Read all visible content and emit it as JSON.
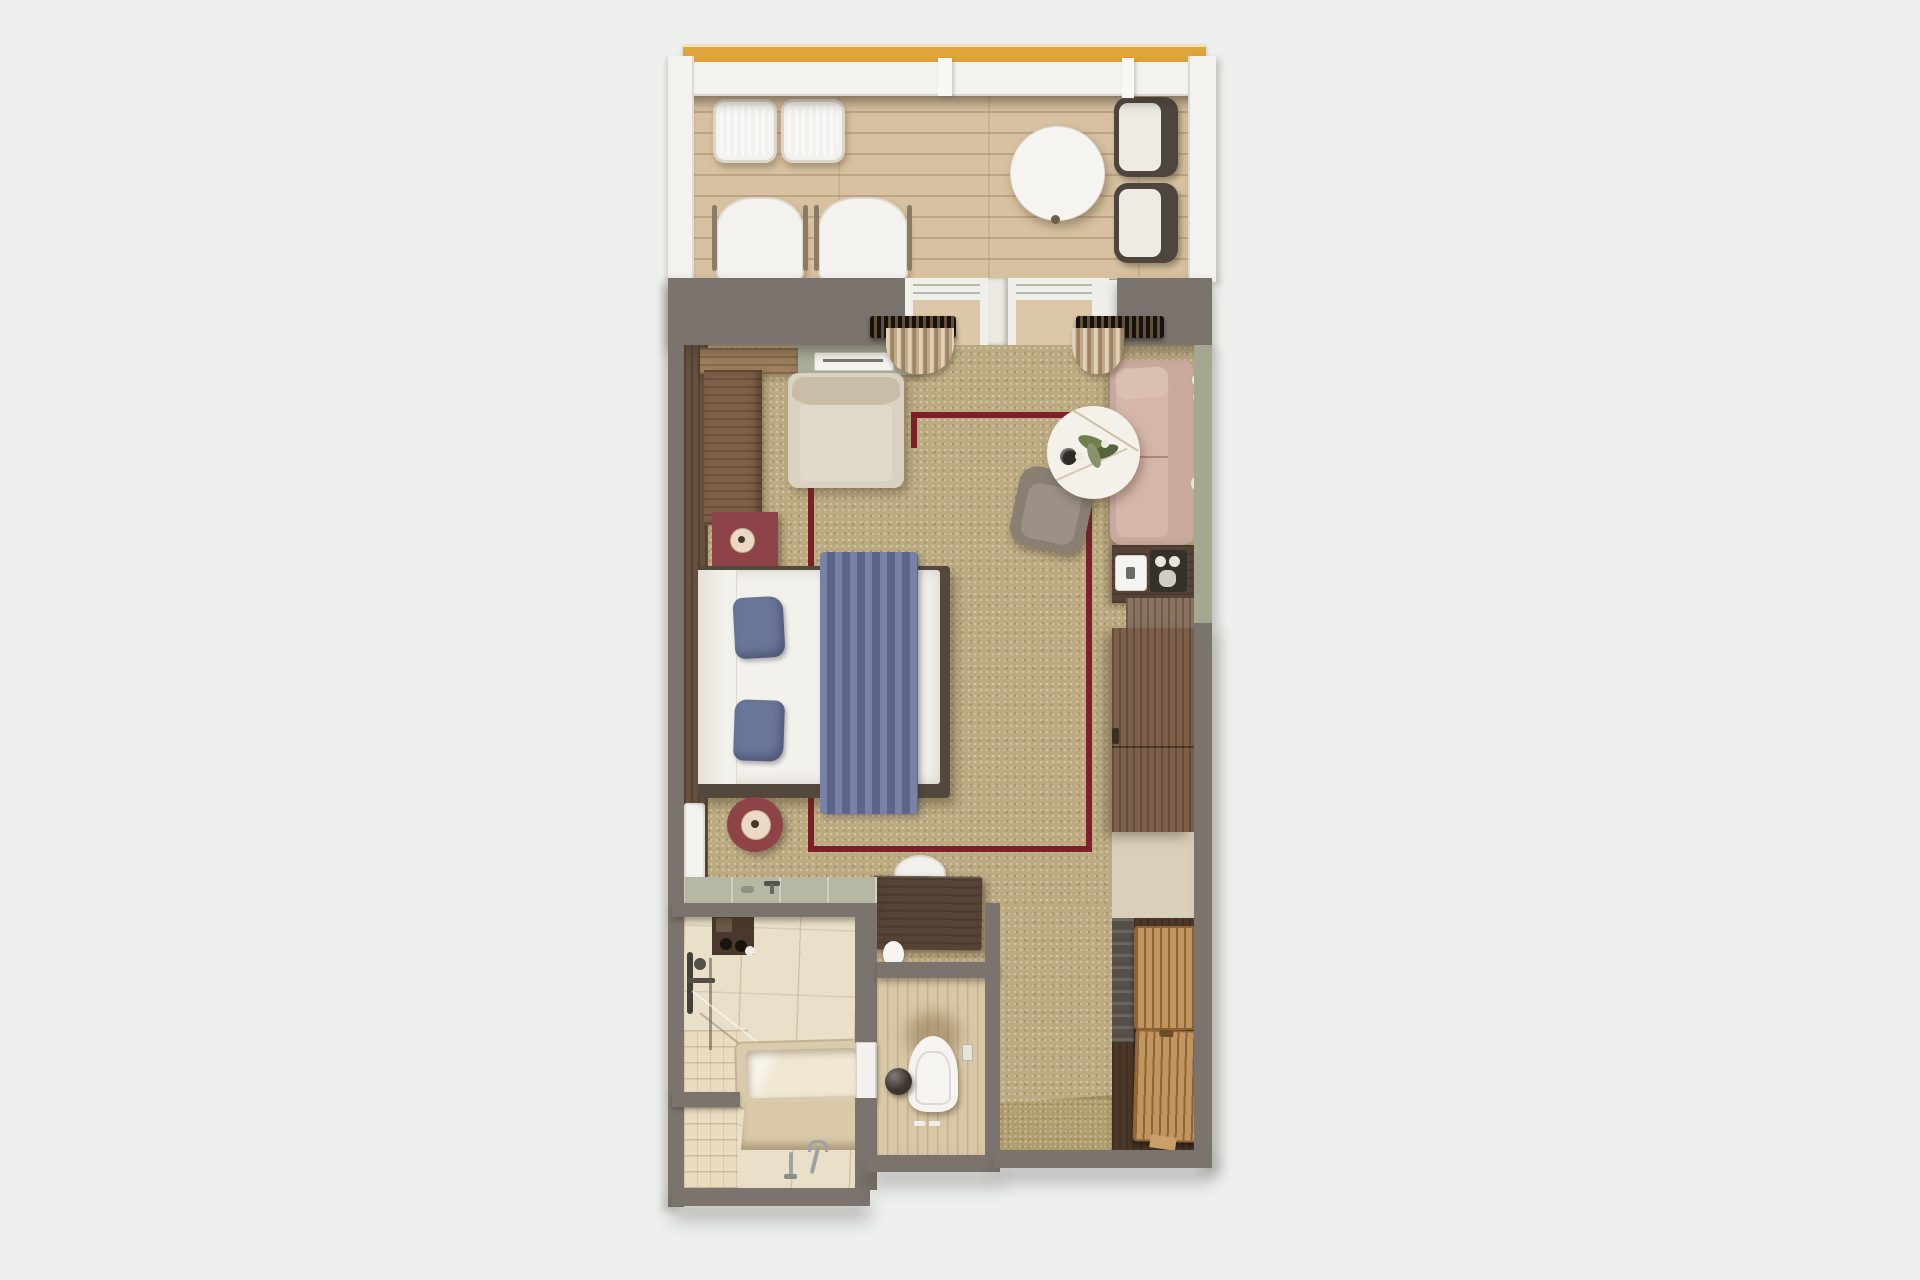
{
  "scene": {
    "type": "floor-plan-render",
    "view": "top-down-3d",
    "subject": "hotel suite with balcony, bedroom, lounge corner, bathroom, wc and entry closet"
  },
  "palette": {
    "background": "#eef0ee",
    "wall_white": "#f3f2ef",
    "railing_gold": "#dfa43c",
    "deck_wood": "#d7c1a0",
    "deck_light": "#dcc8a8",
    "wall_gray": "#7b746e",
    "carpet": "#bcaa81",
    "rug_border": "#7e2029",
    "wood_wall_dark": "#66503f",
    "wood_ledge": "#7e5f49",
    "wood_counter": "#9c7f5d",
    "console_sage": "#a9ae9a",
    "sage_wall": "#a5a791",
    "vanity_sage": "#b6b8a3",
    "bed_white": "#f2f1ec",
    "bed_frame": "#54483c",
    "pillow_blue": "#6a7697",
    "runner_blue": "#68749a",
    "maroon": "#8d4347",
    "candle_cream": "#ead9c5",
    "armchair_beige": "#d9d1c1",
    "armchair_back": "#c9bda8",
    "chaise_blush": "#c9a99e",
    "chaise_seat": "#d6b6aa",
    "tub_chair_gray": "#897f73",
    "marble": "#f3f1ea",
    "leaf_green": "#6f7f4e",
    "walnut_dark": "#554337",
    "walnut_mid": "#7b5f49",
    "oak_cabinet": "#8a7361",
    "rack_oak": "#c3955e",
    "tile_cream": "#eae0ca",
    "plank_light": "#e9dcc0",
    "wc_floor_tan": "#d9c7a6",
    "closet_floor": "#4b3829",
    "fixture_white": "#f5f4f0",
    "sphere_dark": "#3c3530",
    "curtain_tan": "#c2a987",
    "curtain_rod": "#3e352b",
    "mat_gold": "#b19e6e",
    "door_white": "#f2f1ed",
    "stool_white": "#f1f0ec",
    "lounger_white": "#f3f2ee",
    "chair_dark_frame": "#4d463e",
    "chair_cushion": "#edebe3",
    "tray_dark": "#35302a",
    "chrome": "#9fa2a4",
    "tub_inner": "#f0e8d4",
    "tub_rim": "#d9cbab",
    "mirror_white": "#f4f3f0"
  },
  "rooms": {
    "balcony": {
      "furniture": [
        "wicker-footstool",
        "wicker-footstool",
        "lounge-chair",
        "lounge-chair",
        "round-dining-table",
        "dining-armchair",
        "dining-armchair"
      ]
    },
    "bedroom": {
      "furniture": [
        "wood-counter",
        "sage-console-with-tray",
        "reading-armchair",
        "square-nightstand-with-candle",
        "double-bed-with-blue-runner",
        "round-nightstand-with-candle",
        "full-length-mirror",
        "vanity-desk",
        "vanity-stool",
        "area-rug-with-maroon-border",
        "curtain-bundle",
        "curtain-bundle"
      ]
    },
    "lounge_corner": {
      "furniture": [
        "blush-chaise-longue",
        "marble-coffee-table-with-flowers",
        "gray-tub-chair",
        "minibar-counter",
        "coffee-machine",
        "kettle-tray",
        "oak-cabinet",
        "tv-wardrobe-unit"
      ]
    },
    "bathroom": {
      "furniture": [
        "open-vanity-counter-with-faucet",
        "recessed-toiletry-shelf",
        "shower-set",
        "glass-screen",
        "bathtub",
        "floor-mounted-tub-filler"
      ]
    },
    "wc": {
      "furniture": [
        "wall-hung-toilet",
        "decor-sphere",
        "paper-holder",
        "flush-plate"
      ]
    },
    "entry_closet": {
      "furniture": [
        "doormat",
        "closet-side-panel",
        "luggage-bench",
        "luggage-bench",
        "wood-wedge"
      ]
    }
  }
}
